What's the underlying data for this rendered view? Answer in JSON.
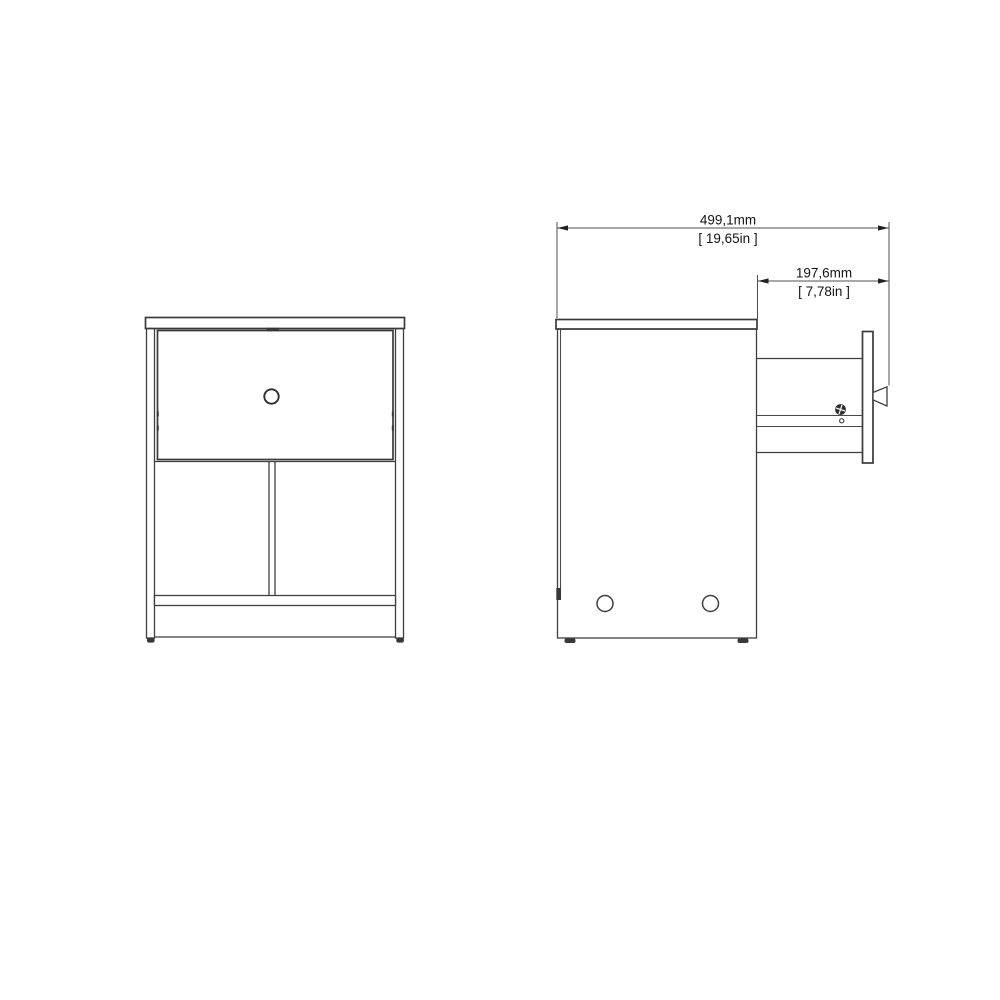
{
  "drawing": {
    "subject": "nightstand-with-open-drawer-technical-drawing",
    "views": {
      "front": "front-orthographic-view",
      "side": "side-orthographic-view-drawer-extended"
    },
    "dimensions": {
      "total_depth": {
        "metric": "499,1mm",
        "imperial": "[ 19,65in ]"
      },
      "drawer_extension": {
        "metric": "197,6mm",
        "imperial": "[ 7,78in ]"
      }
    },
    "icons": {
      "screw_head": "filled-circle-with-cross",
      "knob_front": "circle-outline",
      "knob_side": "tapered-cone"
    },
    "colors": {
      "line": "#3f3f3f",
      "text": "#141414",
      "background": "#ffffff"
    }
  }
}
